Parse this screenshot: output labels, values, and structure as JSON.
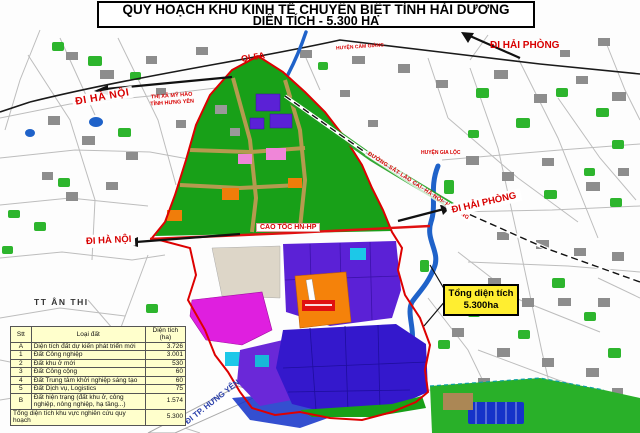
{
  "title": {
    "line1": "QUY HOẠCH KHU KINH TẾ CHUYÊN BIỆT TỈNH HẢI DƯƠNG",
    "line2": "DIỆN TÍCH - 5.300 HA"
  },
  "labels": {
    "ql5a": "QL5A",
    "di_ha_noi_top": "ĐI HÀ NỘI",
    "thi_xa_my_hao": "THỊ XÃ MỸ HÀO",
    "tinh_hung_yen": "TỈNH HƯNG YÊN",
    "huyen_cam_giang": "HUYỆN CẨM GIÀNG",
    "di_hai_phong_top": "ĐI HẢI PHÒNG",
    "huyen_gia_loc": "HUYỆN GIA LỘC",
    "duong_sat": "ĐƯỜNG SẮT LÀO CAI- HÀ NỘI- HẠ LONG",
    "di_hai_phong_mid": "ĐI HẢI PHÒNG",
    "cao_toc": "CAO TỐC HN-HP",
    "di_ha_noi_mid": "ĐI HÀ NỘI",
    "tt_an_thi": "TT ÂN THI",
    "di_tp_hung_yen": "ĐI TP. HƯNG YÊN"
  },
  "callout": {
    "line1": "Tổng diện tích",
    "line2": "5.300ha"
  },
  "land_table": {
    "headers": {
      "stt": "Stt",
      "loai_dat": "Loại đất",
      "dien_tich": "Diện tích (ha)"
    },
    "rows": [
      {
        "stt": "A",
        "loai_dat": "Diện tích đất dự kiến phát triển mới",
        "dien_tich": "3.726"
      },
      {
        "stt": "1",
        "loai_dat": "Đất Công nghiệp",
        "dien_tich": "3.001"
      },
      {
        "stt": "2",
        "loai_dat": "Đất khu ở mới",
        "dien_tich": "530"
      },
      {
        "stt": "3",
        "loai_dat": "Đất Công cộng",
        "dien_tich": "60"
      },
      {
        "stt": "4",
        "loai_dat": "Đất Trung tâm khởi nghiệp sáng tạo",
        "dien_tich": "60"
      },
      {
        "stt": "5",
        "loai_dat": "Đất Dịch vụ, Logistics",
        "dien_tich": "75"
      },
      {
        "stt": "B",
        "loai_dat": "Đất hiện trạng (đất khu ở, công nghiệp, nông nghiệp, hạ tầng...)",
        "dien_tich": "1.574"
      }
    ],
    "footer": {
      "label": "Tổng diện tích khu vực nghiên cứu quy hoạch",
      "value": "5.300"
    }
  },
  "colors": {
    "label_red": "#d80000",
    "callout_yellow": "#ffee30",
    "table_bg": "#ffffcc",
    "zone_green": "#18a018",
    "zone_purple": "#5b21d6",
    "zone_magenta": "#df1fdf",
    "zone_orange": "#f5820a",
    "zone_indigo": "#3418cc",
    "highway_red": "#e01010",
    "river_blue": "#1f62c9"
  }
}
